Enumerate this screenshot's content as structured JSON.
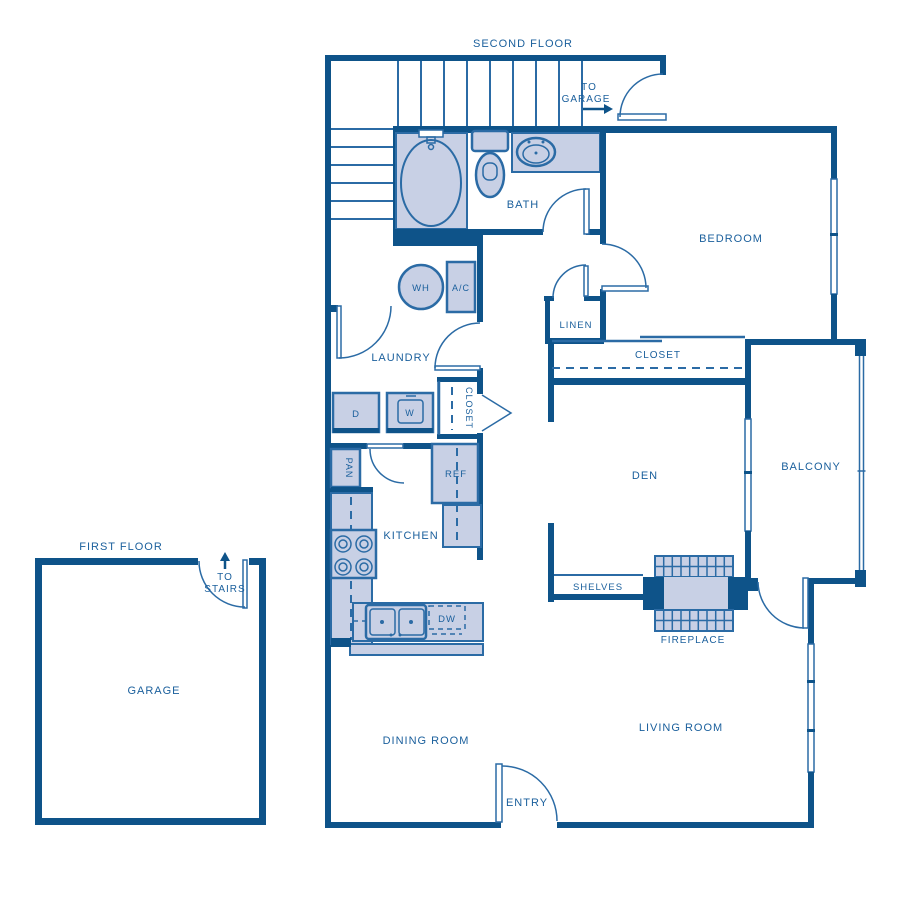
{
  "palette": {
    "wall": "#0E5389",
    "line": "#2B6BA5",
    "fill": "#C8D0E5",
    "text": "#1A5F9C",
    "bg": "#FFFFFF"
  },
  "floors": {
    "second": "SECOND FLOOR",
    "first": "FIRST FLOOR"
  },
  "rooms": {
    "bedroom": "BEDROOM",
    "bath": "BATH",
    "laundry": "LAUNDRY",
    "kitchen": "KITCHEN",
    "den": "DEN",
    "balcony": "BALCONY",
    "living_room": "LIVING ROOM",
    "dining_room": "DINING ROOM",
    "entry": "ENTRY",
    "garage": "GARAGE"
  },
  "storage": {
    "linen": "LINEN",
    "bedroom_closet": "CLOSET",
    "hall_closet": "CLOSET",
    "pantry": "PAN",
    "shelves": "SHELVES"
  },
  "appliances": {
    "water_heater": "WH",
    "ac_unit": "A/C",
    "dryer": "D",
    "washer": "W",
    "refrigerator": "REF",
    "dishwasher": "DW"
  },
  "features": {
    "fireplace": "FIREPLACE"
  },
  "nav": {
    "to_garage": {
      "line1": "TO",
      "line2": "GARAGE"
    },
    "to_stairs": {
      "line1": "TO",
      "line2": "STAIRS"
    }
  }
}
